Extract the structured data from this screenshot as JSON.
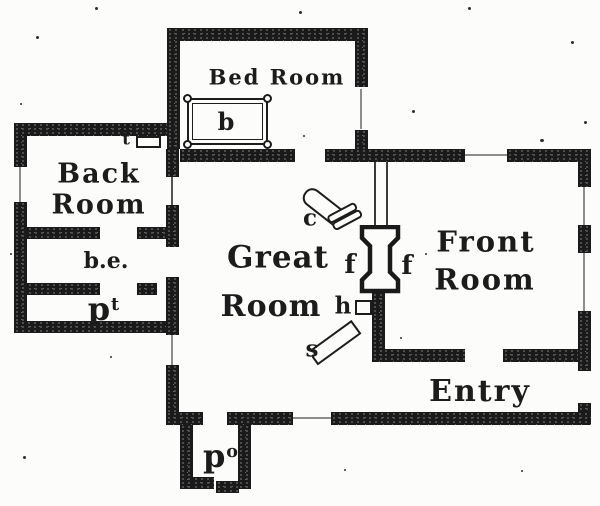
{
  "plan": {
    "rooms": {
      "bed_room": "Bed Room",
      "back_line1": "Back",
      "back_line2": "Room",
      "great_line1": "Great",
      "great_line2": "Room",
      "front_line1": "Front",
      "front_line2": "Room",
      "entry": "Entry"
    },
    "labels": {
      "bed": "b",
      "table": "t",
      "back_entry": "b.e.",
      "pantry_base": "p",
      "pantry_sup": "t",
      "porch_base": "p",
      "porch_sup": "o",
      "chair": "c",
      "fireplace_left": "f",
      "fireplace_right": "f",
      "hearth": "h",
      "settle": "s"
    },
    "colors": {
      "ink": "#1c1c1c",
      "paper": "#fcfcfa",
      "window_line": "#8d8d8d"
    }
  }
}
